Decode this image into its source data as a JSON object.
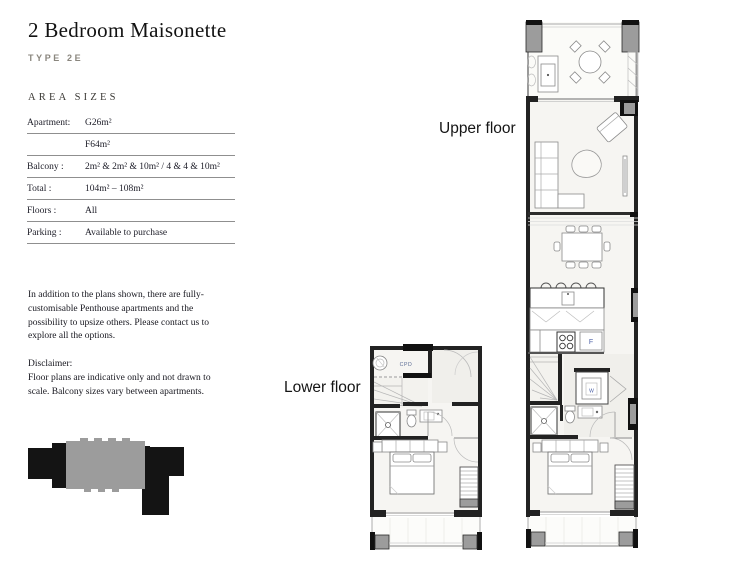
{
  "header": {
    "title": "2 Bedroom Maisonette",
    "type_label": "TYPE 2E",
    "area_sizes_heading": "AREA SIZES"
  },
  "area_table": {
    "rows": [
      {
        "label": "Apartment:",
        "value": "G26m²"
      },
      {
        "label": "",
        "value": "F64m²"
      },
      {
        "label": "Balcony :",
        "value": "2m² & 2m² & 10m² / 4 & 4 & 10m²"
      },
      {
        "label": "Total :",
        "value": "104m² – 108m²"
      },
      {
        "label": "Floors :",
        "value": "All"
      },
      {
        "label": "Parking :",
        "value": "Available to purchase"
      }
    ]
  },
  "notes": {
    "intro": "In addition to the plans shown, there are fully-customisable Penthouse apartments and the possibility to upsize others. Please contact us to explore all the options.",
    "disclaimer_heading": "Disclaimer:",
    "disclaimer_body": "Floor plans are indicative only and not drawn to scale. Balcony sizes vary between apartments."
  },
  "floor_plans": {
    "upper_label": "Upper floor",
    "lower_label": "Lower floor",
    "annotations": {
      "fridge": "F",
      "washer": "W",
      "cupboard": "CPD"
    }
  },
  "colors": {
    "highlight_gray": "#9c9c9c",
    "footprint_black": "#141414",
    "annotation_blue": "#4a5fa5"
  }
}
